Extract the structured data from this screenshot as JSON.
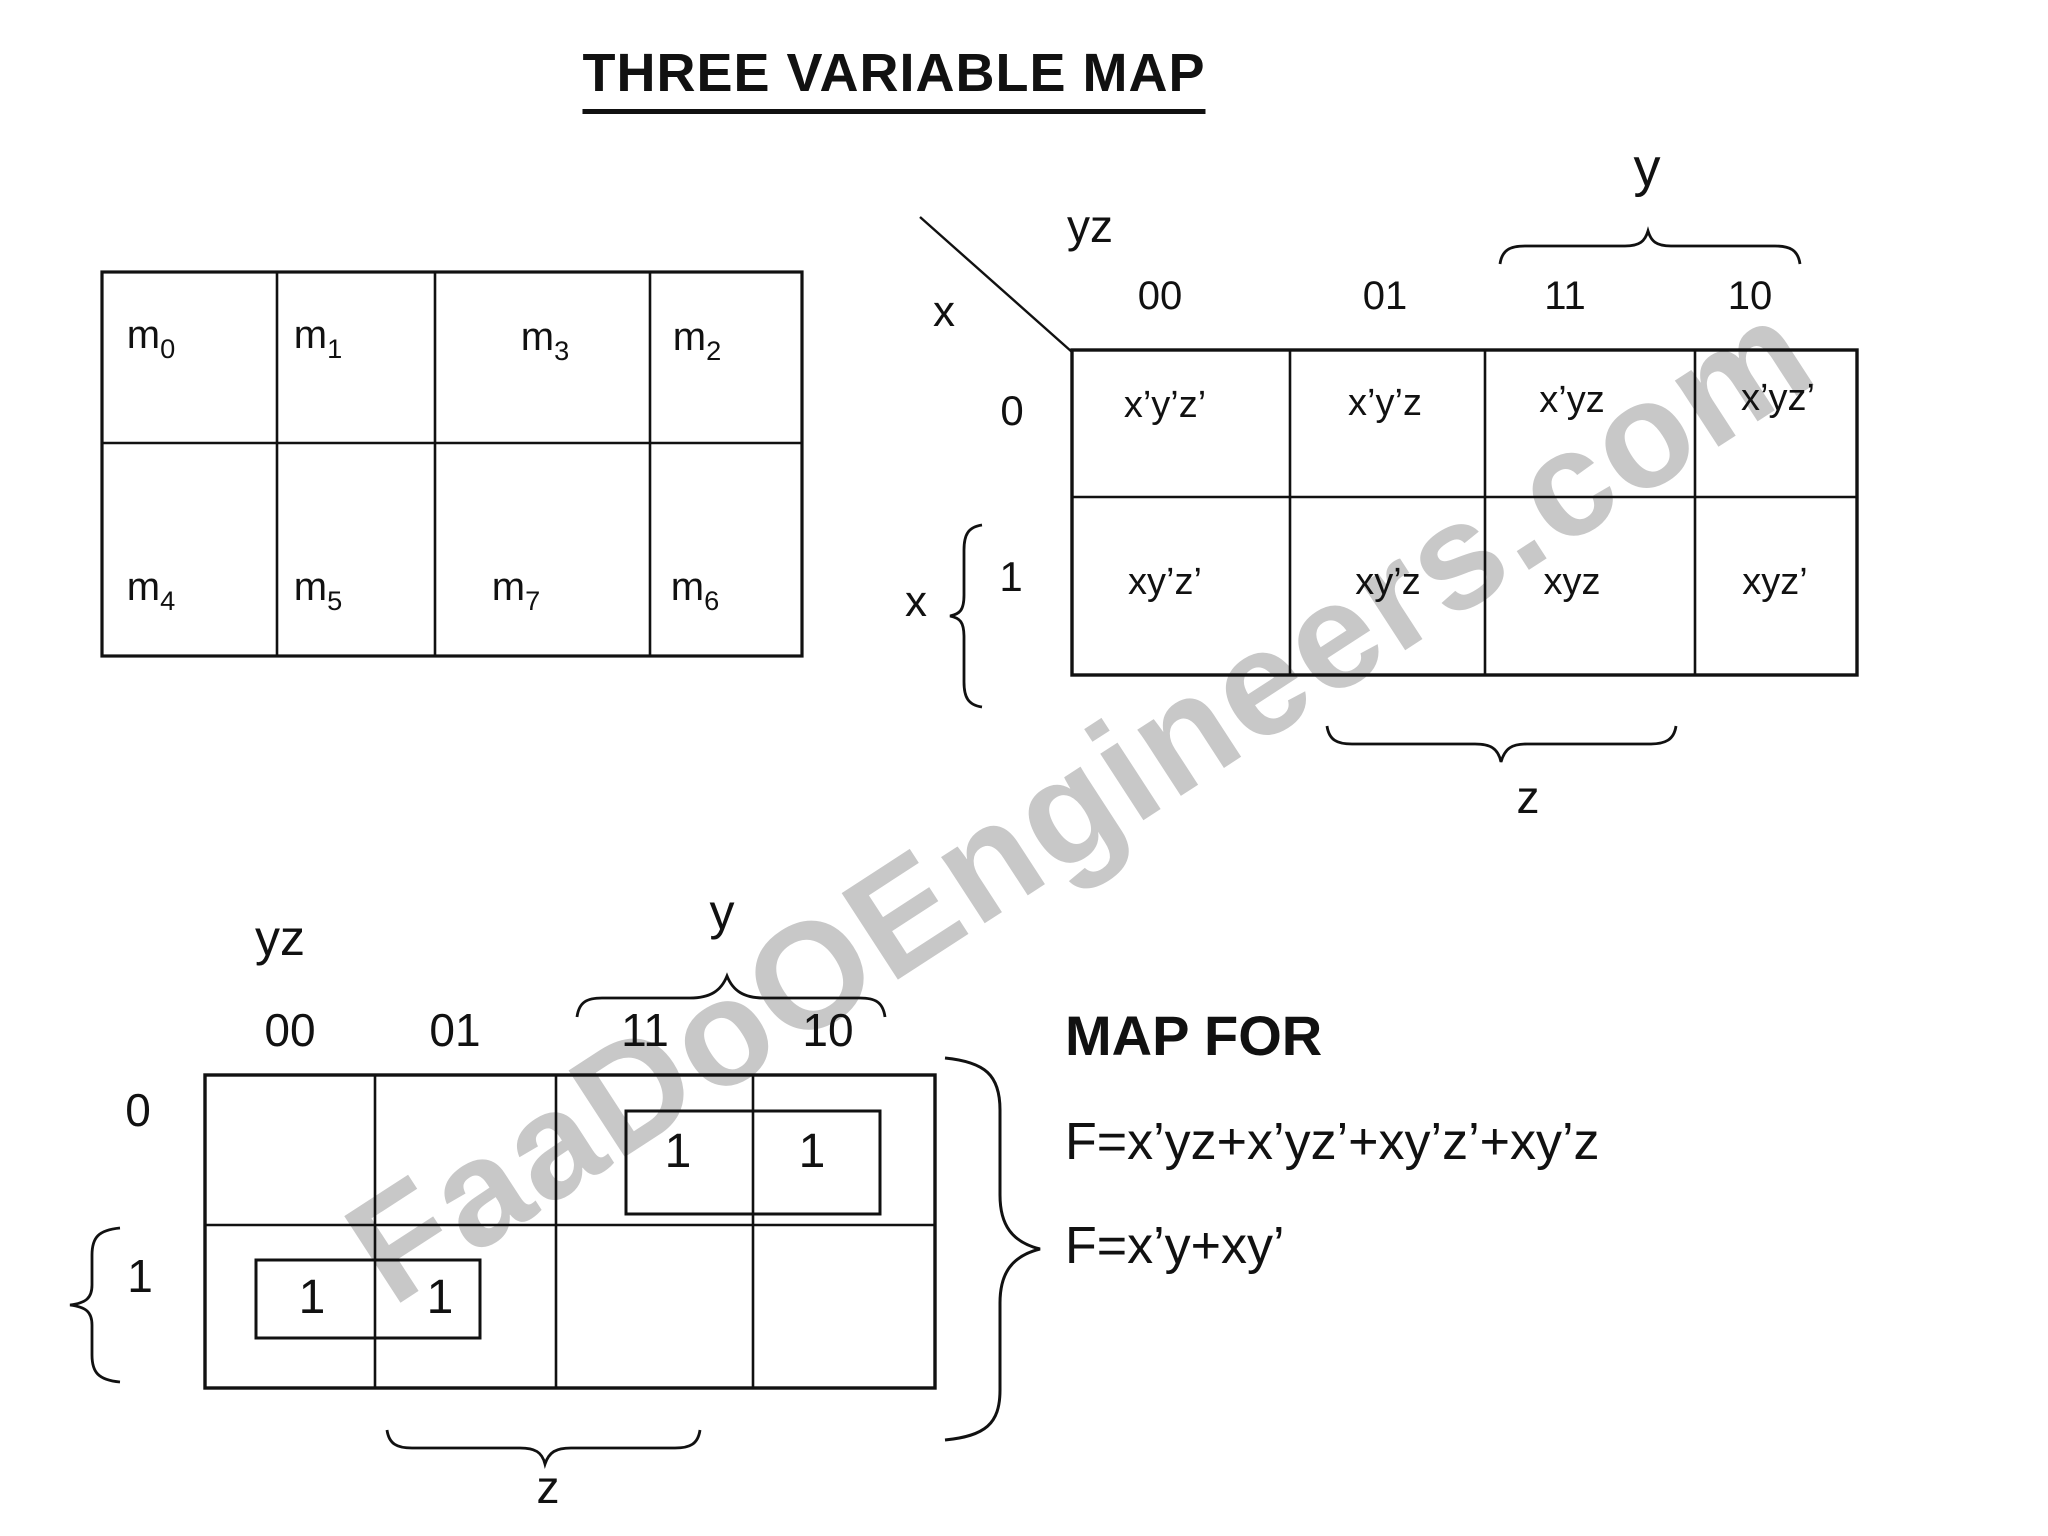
{
  "title": "THREE VARIABLE MAP",
  "watermark": "FaaDoOEngineers.com",
  "colors": {
    "ink": "#111111",
    "watermark": "#c8c8c8",
    "background": "#ffffff"
  },
  "minterm_table": {
    "cells": [
      {
        "base": "m",
        "sub": "0"
      },
      {
        "base": "m",
        "sub": "1"
      },
      {
        "base": "m",
        "sub": "3"
      },
      {
        "base": "m",
        "sub": "2"
      },
      {
        "base": "m",
        "sub": "4"
      },
      {
        "base": "m",
        "sub": "5"
      },
      {
        "base": "m",
        "sub": "7"
      },
      {
        "base": "m",
        "sub": "6"
      }
    ]
  },
  "top_map": {
    "corner_label": "yz",
    "x_header_label": "x",
    "col_labels": [
      "00",
      "01",
      "11",
      "10"
    ],
    "row_labels": [
      "0",
      "1"
    ],
    "x_brace_label": "x",
    "y_brace_label": "y",
    "z_brace_label": "z",
    "cells": [
      "x’y’z’",
      "x’y’z",
      "x’yz",
      "x’yz’",
      "xy’z’",
      "xy’z",
      "xyz",
      "xyz’"
    ]
  },
  "bottom_map": {
    "corner_label": "yz",
    "col_labels": [
      "00",
      "01",
      "11",
      "10"
    ],
    "row_labels": [
      "0",
      "1"
    ],
    "y_brace_label": "y",
    "z_brace_label": "z",
    "ones": [
      "1",
      "1",
      "1",
      "1"
    ]
  },
  "map_for": {
    "heading": "MAP FOR",
    "line1": "F=x’yz+x’yz’+xy’z’+xy’z",
    "line2": "F=x’y+xy’"
  }
}
